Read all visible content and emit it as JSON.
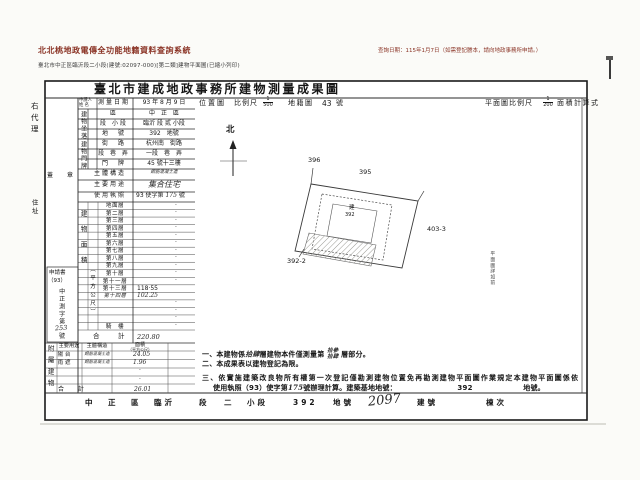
{
  "header": {
    "system_title": "北北桃地政電傳全功能地籍資料查詢系統",
    "query_date": "查詢日期：115年1月7日（如需登記謄本，請向地政事務所申請。）",
    "doc_line": "臺北市中正區臨沂段二小段(建號:02097-000)[第二類]建物平面圖(已縮小列印)"
  },
  "form": {
    "title": "臺北市建成地政事務所建物測量成果圖",
    "margin": {
      "agent": "右代理",
      "address": "住址",
      "seal": "蓋　章",
      "applicant_l1": "申請人",
      "applicant_l2": "姓 名",
      "app_book": "申請書",
      "app_year": "（93）",
      "app_body": "中正測字第",
      "app_no": "253",
      "app_suffix": "號"
    },
    "groups": {
      "zuoluo": "建物坐落",
      "menpai": "建物門牌"
    },
    "info_rows": [
      {
        "label": "測量日期",
        "value": "93 年 8 月 9 日"
      },
      {
        "label": "區",
        "value": "中　正　區"
      },
      {
        "label": "段 小段",
        "value": "臨沂 段 貳 小段"
      },
      {
        "label": "地　號",
        "value": "392　地號"
      },
      {
        "label": "街　路",
        "value": "杭州南　街路"
      },
      {
        "label": "段 巷 弄",
        "value": "一段　巷　弄"
      },
      {
        "label": "門　牌",
        "value": "45 號十三樓"
      },
      {
        "label": "主體構造",
        "value": "鋼筋混凝土造",
        "hw": true,
        "small": true
      },
      {
        "label": "主要用途",
        "value": "集合住宅",
        "hw": true
      },
      {
        "label": "使用執照",
        "value_pre": "93 使字第",
        "value_hw": "175",
        "value_suf": "號"
      }
    ],
    "floors": {
      "title_v": "建物面積",
      "unit_v": "（平方公尺）",
      "rows": [
        {
          "label": "地面層",
          "value": "·"
        },
        {
          "label": "第二層",
          "value": "·"
        },
        {
          "label": "第三層",
          "value": "·"
        },
        {
          "label": "第四層",
          "value": "·"
        },
        {
          "label": "第五層",
          "value": "·"
        },
        {
          "label": "第六層",
          "value": "·"
        },
        {
          "label": "第七層",
          "value": "·"
        },
        {
          "label": "第八層",
          "value": "·"
        },
        {
          "label": "第九層",
          "value": "·"
        },
        {
          "label": "第十層",
          "value": "·"
        },
        {
          "label": "第十一層",
          "value": "·"
        },
        {
          "label": "第十三層",
          "value": "118·55"
        },
        {
          "label": "第十四層",
          "value": "102.25",
          "hw": true
        },
        {
          "label": "",
          "value": "·"
        },
        {
          "label": "",
          "value": "·"
        },
        {
          "label": "",
          "value": "·"
        },
        {
          "label": "騎　樓",
          "value": "·"
        }
      ],
      "total_label": "合　計",
      "total_value": "220.80"
    },
    "annex": {
      "title_v": "附屬建物",
      "headers": [
        "主要用途",
        "主體構造",
        "面積",
        "（平方公尺）"
      ],
      "rows": [
        {
          "use": "陽 台",
          "structure": "鋼筋混凝土造",
          "area": "24.05"
        },
        {
          "use": "雨 遮",
          "structure": "鋼筋混凝土造",
          "area": "1.96"
        },
        {
          "use": "",
          "structure": "",
          "area": "·"
        },
        {
          "use": "",
          "structure": "",
          "area": "·"
        }
      ],
      "total_label": "合　計",
      "total_value": "26.01"
    }
  },
  "scale_row": {
    "location_map": "位置圖",
    "scale_label": "比例尺",
    "scale_num": "1",
    "scale_den": "500",
    "cadastral": "地籍圖",
    "sheet_no": "43",
    "sheet_unit": "號",
    "plan_scale_label": "平面圖比例尺",
    "plan_num": "1",
    "plan_den": "200",
    "area_calc": "面積計算式"
  },
  "map": {
    "north": "北",
    "parcel_396": "396",
    "parcel_395": "395",
    "parcel_403_3": "403-3",
    "parcel_392_2": "392-2",
    "inner_label_top": "建",
    "inner_label_no": "392",
    "side_note": "平面圖詳如前"
  },
  "notes": {
    "n1_a": "一、本建物係",
    "n1_hw1": "拾肆",
    "n1_b": "層建物本件僅測量第",
    "n1_hw2a": "拾參",
    "n1_hw2b": "拾肆",
    "n1_c": "層部分。",
    "n2": "二、本成果表以建物登記為限。",
    "n3_line1": "三、依實施建築改良物所有權第一次登記僅勘測建物位置免再勘測建物平面圖作業規定本建物平面圖係依",
    "n3_line2a": "使用執照（93）使字第",
    "n3_hw": "175",
    "n3_line2b": "號辦理計算。建築基地地號：",
    "n3_parcel": "392",
    "n3_line2c": "地號。"
  },
  "footer": {
    "parts": [
      "中",
      "正",
      "區",
      "臨沂",
      "段",
      "二",
      "小段",
      "392",
      "地號"
    ],
    "building_no_hw": "2097",
    "building_label": "建號",
    "dong_label": "棟次"
  }
}
